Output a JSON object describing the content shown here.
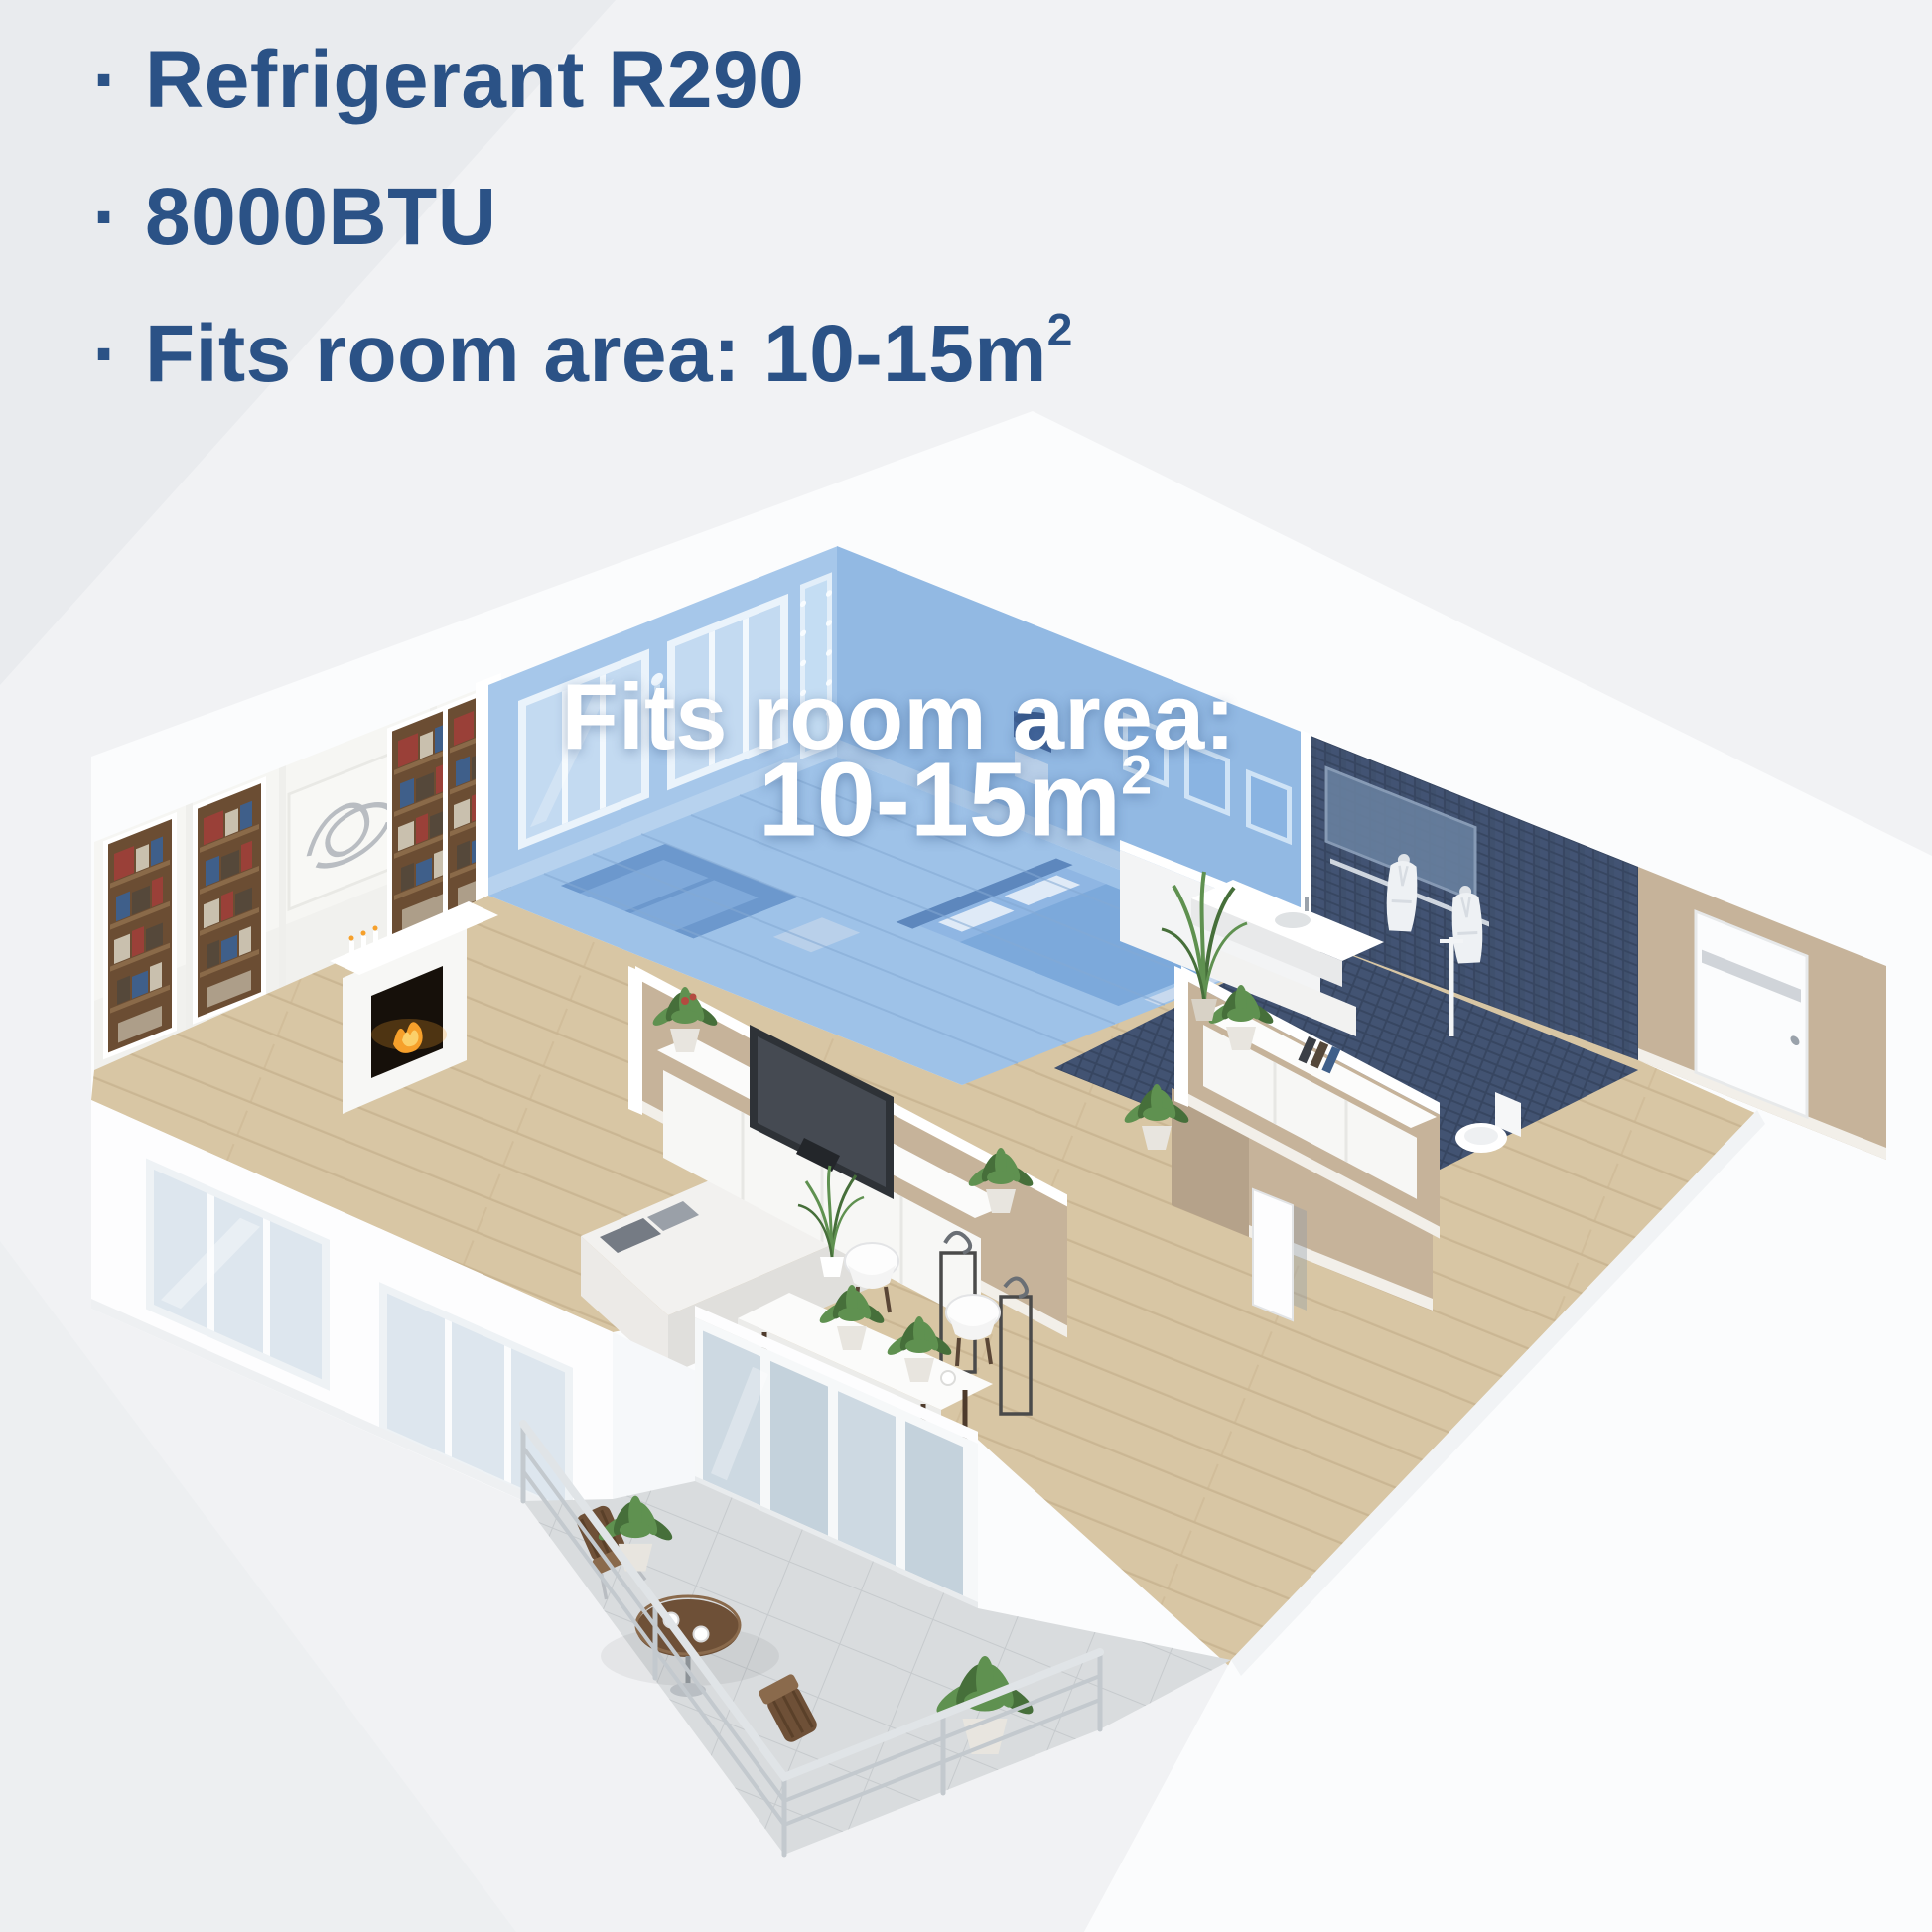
{
  "specs": {
    "items": [
      {
        "bullet": "·",
        "text": "Refrigerant R290",
        "sup": ""
      },
      {
        "bullet": "·",
        "text": "8000BTU",
        "sup": ""
      },
      {
        "bullet": "·",
        "text": "Fits room area: 10-15m",
        "sup": "2"
      }
    ]
  },
  "floorplan_overlay": {
    "line1": "Fits room area:",
    "line2": "10-15m",
    "sup": "2"
  },
  "colors": {
    "text-blue": "#2b5286",
    "overlay-white": "#ffffff",
    "bg": "#f1f2f4",
    "bg-shade": "#e9ebee",
    "bg-shade2": "#edeff1",
    "wall-white": "#fbfcfd",
    "wall-bright": "#ffffff",
    "highlight-wall": "#a6c7ea",
    "highlight-wall-dark": "#92b9e3",
    "highlight-floor": "#9ec2e8",
    "glass-blue": "#c3daf1",
    "frame-blue": "#8ab4e2",
    "wood": "#d8c6a4",
    "wood-line": "#c2ab87",
    "tan-wall": "#c6b39a",
    "tan-wall-dark": "#b5a28a",
    "tan-light": "#d8cbb8",
    "navy": "#3c4c68",
    "navy-tile": "#46587a",
    "navy-gap": "#33425c",
    "fire": "#f6a02b",
    "green": "#5f9150",
    "tile": "#d9dcde",
    "rail": "#c3c9ce",
    "bistro": "#6e5037",
    "tv": "#2e3237",
    "robe": "#eef1f4"
  }
}
